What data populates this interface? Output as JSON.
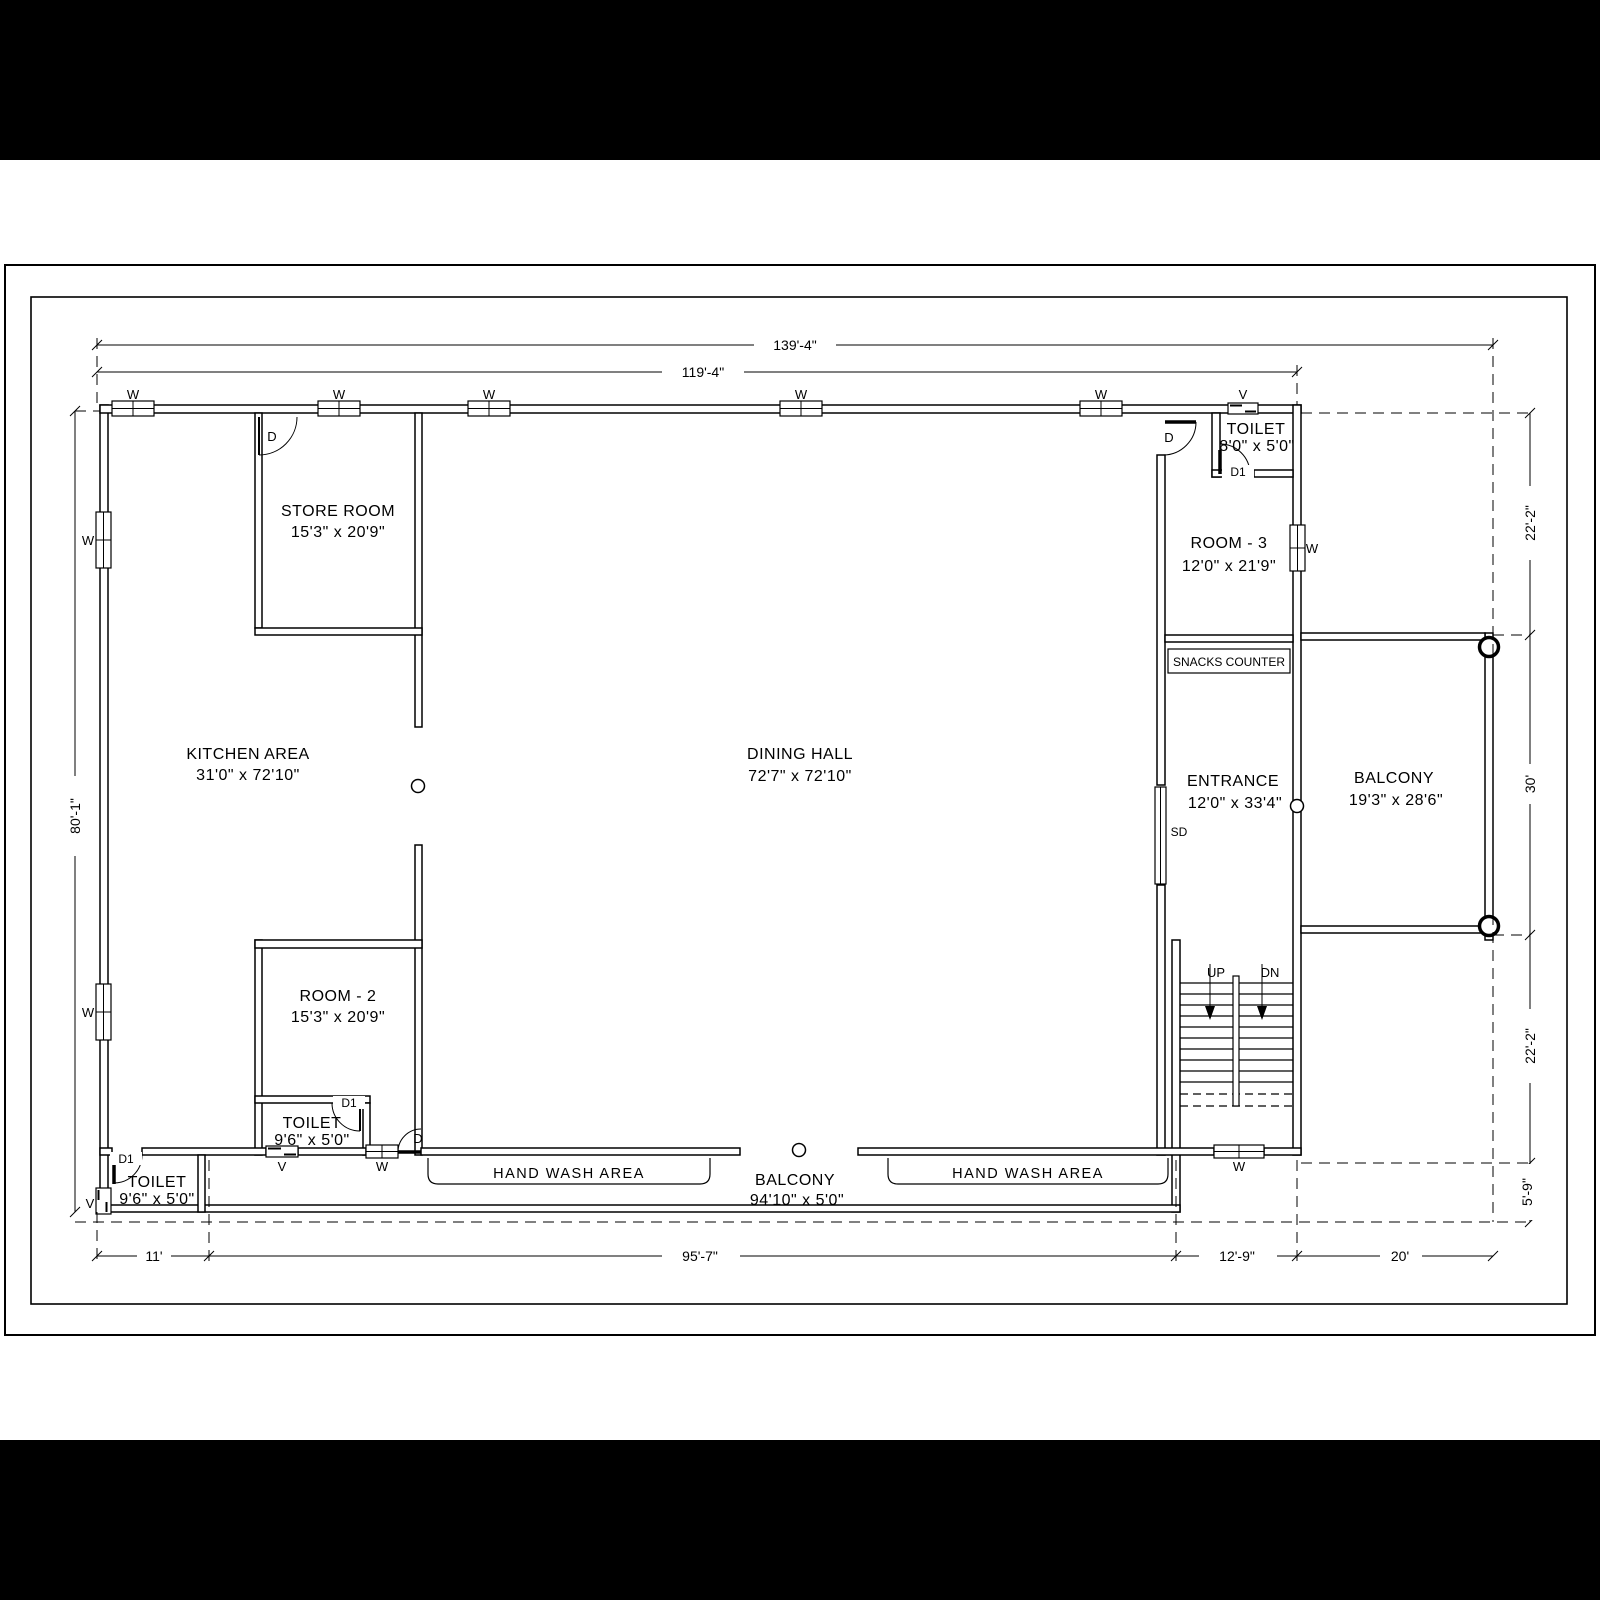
{
  "drawing": {
    "rooms": [
      {
        "name": "STORE ROOM",
        "size": "15'3\" x 20'9\""
      },
      {
        "name": "KITCHEN AREA",
        "size": "31'0\" x 72'10\""
      },
      {
        "name": "DINING HALL",
        "size": "72'7\" x 72'10\""
      },
      {
        "name": "ROOM - 2",
        "size": "15'3\" x 20'9\""
      },
      {
        "name": "TOILET",
        "size": "9'6\" x 5'0\""
      },
      {
        "name": "TOILET",
        "size": "9'6\" x 5'0\""
      },
      {
        "name": "ROOM - 3",
        "size": "12'0\" x 21'9\""
      },
      {
        "name": "TOILET",
        "size": "8'0\" x 5'0\""
      },
      {
        "name": "ENTRANCE",
        "size": "12'0\" x 33'4\""
      },
      {
        "name": "BALCONY",
        "size": "19'3\" x 28'6\""
      },
      {
        "name": "BALCONY",
        "size": "94'10\" x 5'0\""
      }
    ],
    "areas": {
      "snacks": "SNACKS COUNTER",
      "hand_wash": "HAND WASH AREA"
    },
    "stairs": {
      "up": "UP",
      "down": "DN"
    },
    "symbols": {
      "window": "W",
      "ventilator": "V",
      "door": "D",
      "door_small": "D1",
      "sliding_door": "SD"
    },
    "dimensions": {
      "top": [
        "139'-4\"",
        "119'-4\""
      ],
      "bottom": [
        "11'",
        "95'-7\"",
        "12'-9\"",
        "20'"
      ],
      "left": [
        "80'-1\""
      ],
      "right": [
        "22'-2\"",
        "30'",
        "22'-2\"",
        "5'-9\""
      ]
    }
  }
}
